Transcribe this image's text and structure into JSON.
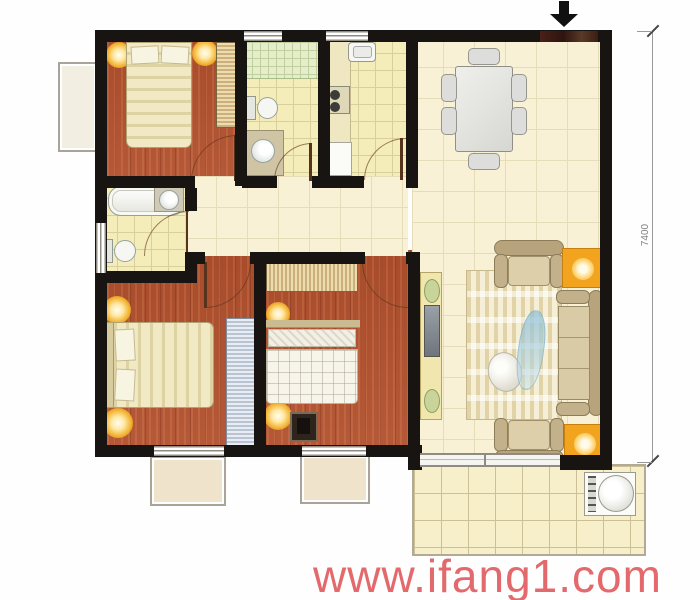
{
  "floorplan": {
    "watermark": {
      "text": "www.ifang1.com",
      "color": "#e0595c"
    },
    "dimensions": {
      "right_label": "7400"
    },
    "colors": {
      "wall": "#181411",
      "wood_floor": "#b2502d",
      "bath_tile": "#f4ecb9",
      "hall_tile": "#f8f1d6",
      "balcony_tile": "#f7efc9",
      "accent_orange": "#f2a41f",
      "sofa_tan": "#cdbb97",
      "watermark_red": "#e0595c"
    },
    "rooms": [
      "bedroom-1",
      "bathroom-1",
      "kitchen",
      "dining-area",
      "hallway",
      "bathroom-2",
      "bedroom-2",
      "bedroom-3",
      "living-room",
      "balcony"
    ],
    "furniture_icons": [
      "double-bed",
      "pillow",
      "wardrobe",
      "wall-lamp",
      "toilet",
      "washbasin",
      "bathtub",
      "shower-area",
      "kitchen-sink",
      "stove",
      "counter",
      "dining-table",
      "dining-chair",
      "sofa",
      "armchair",
      "side-table-lamp",
      "rug",
      "tv-cabinet",
      "tv",
      "washing-machine",
      "sliding-door",
      "entry-arrow"
    ]
  }
}
